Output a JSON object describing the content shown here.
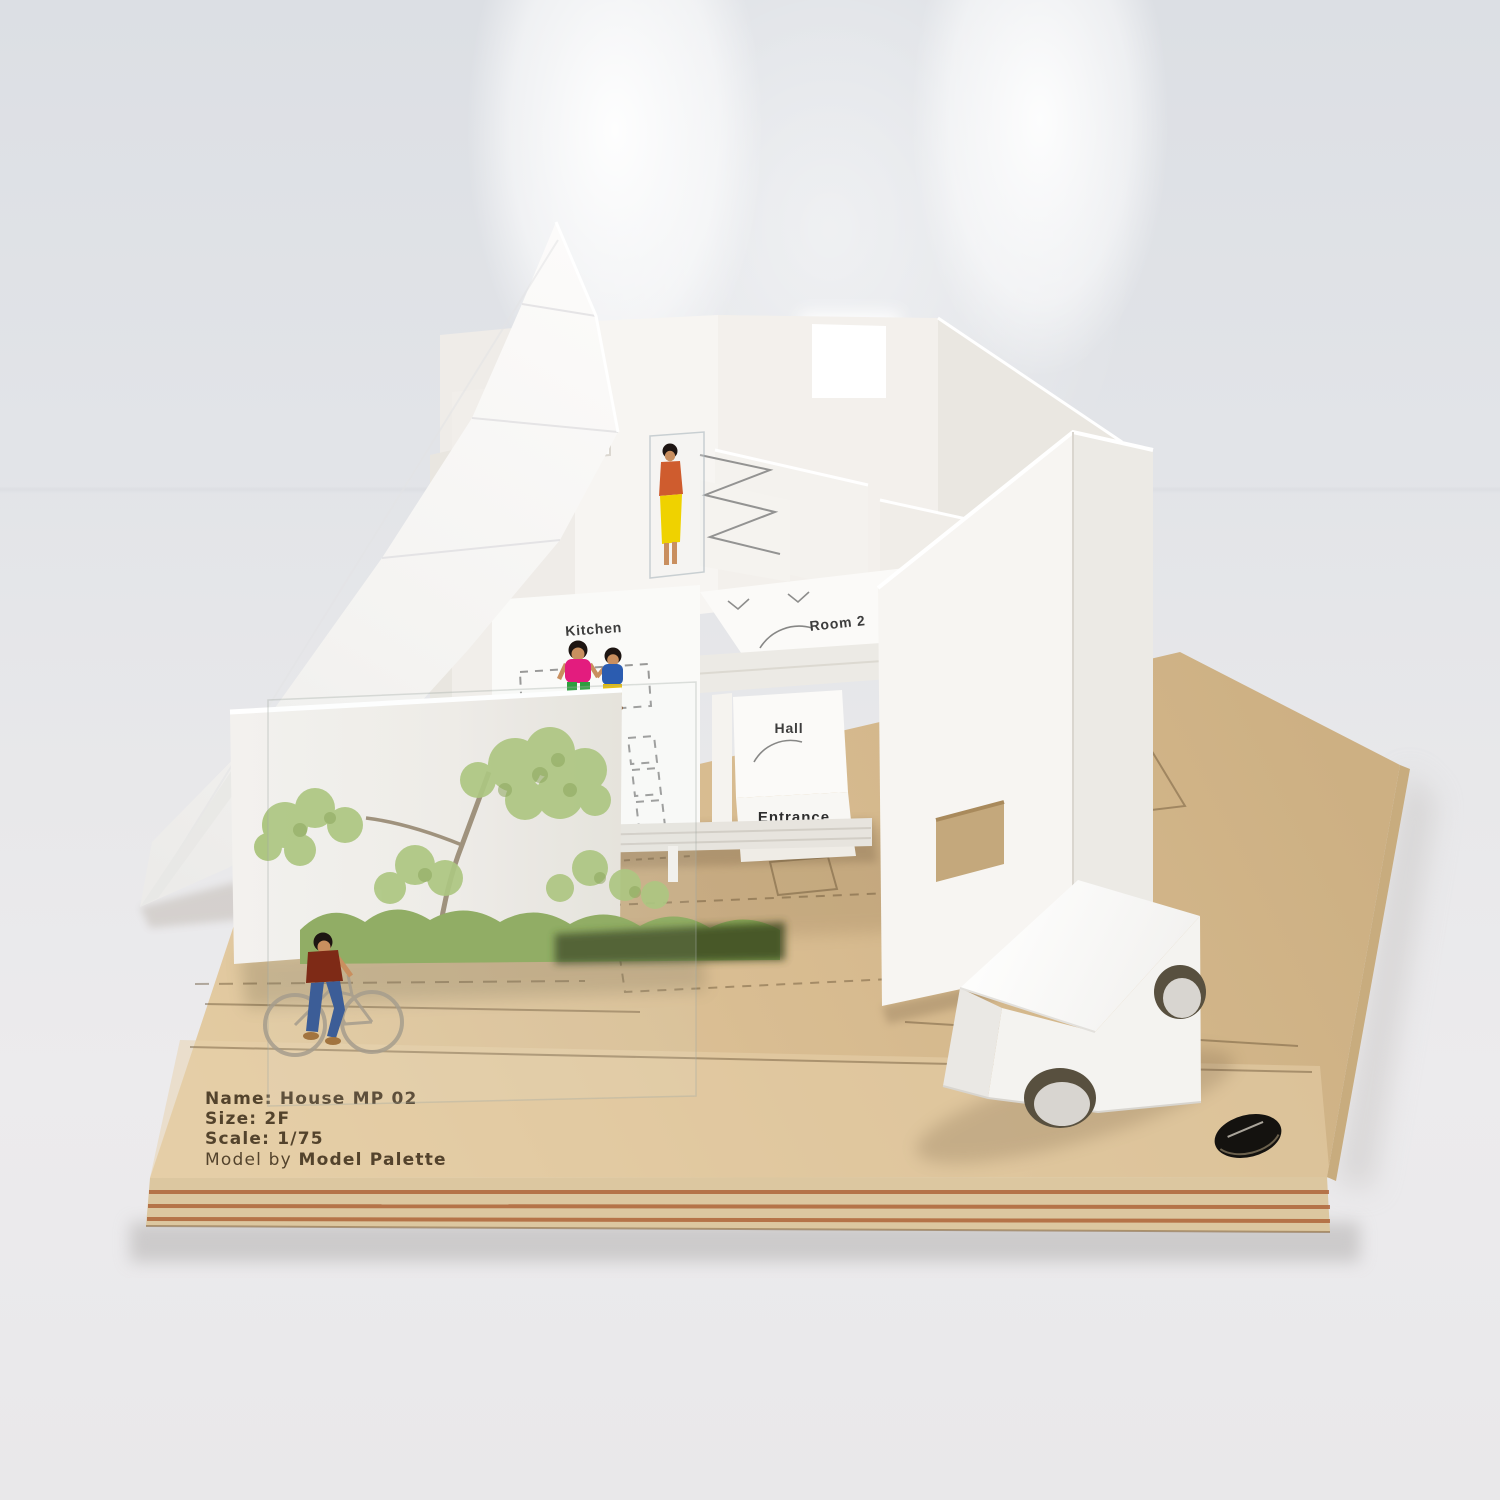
{
  "base_plate": {
    "name": "Name: House MP 02",
    "size": "Size: 2F",
    "scale": "Scale: 1/75",
    "credit_prefix": "Model by ",
    "credit_brand": "Model Palette"
  },
  "room_labels": {
    "kitchen": "Kitchen",
    "room2": "Room 2",
    "hall": "Hall",
    "entrance": "Entrance"
  },
  "palette": {
    "wood": "#d9bd92",
    "wood_light": "#e6d2ae",
    "wood_dark": "#c2a276",
    "wood_stripe": "#a8572b",
    "white": "#f7f5f2",
    "white_shade": "#eae7e1",
    "white_shade2": "#dedad3",
    "engrave": "#40301c",
    "label": "#3d3d3d",
    "tree": "#a9c379",
    "tree_dark": "#85a050",
    "hedge": "#8aa859",
    "hedge_dark": "#39441f",
    "skin": "#c98f5f",
    "hair": "#1d1512",
    "mom_top": "#e31c7e",
    "mom_pants": "#2f9e3f",
    "kid_top": "#2b5cb0",
    "kid_shorts": "#e6bb00",
    "woman_top": "#cf5c2e",
    "woman_skirt": "#efd200",
    "cyclist_top": "#7e2a16",
    "cyclist_pants": "#3c5d97",
    "bike_print": "#a69d8d",
    "shadow_warm": "#6b543a"
  }
}
